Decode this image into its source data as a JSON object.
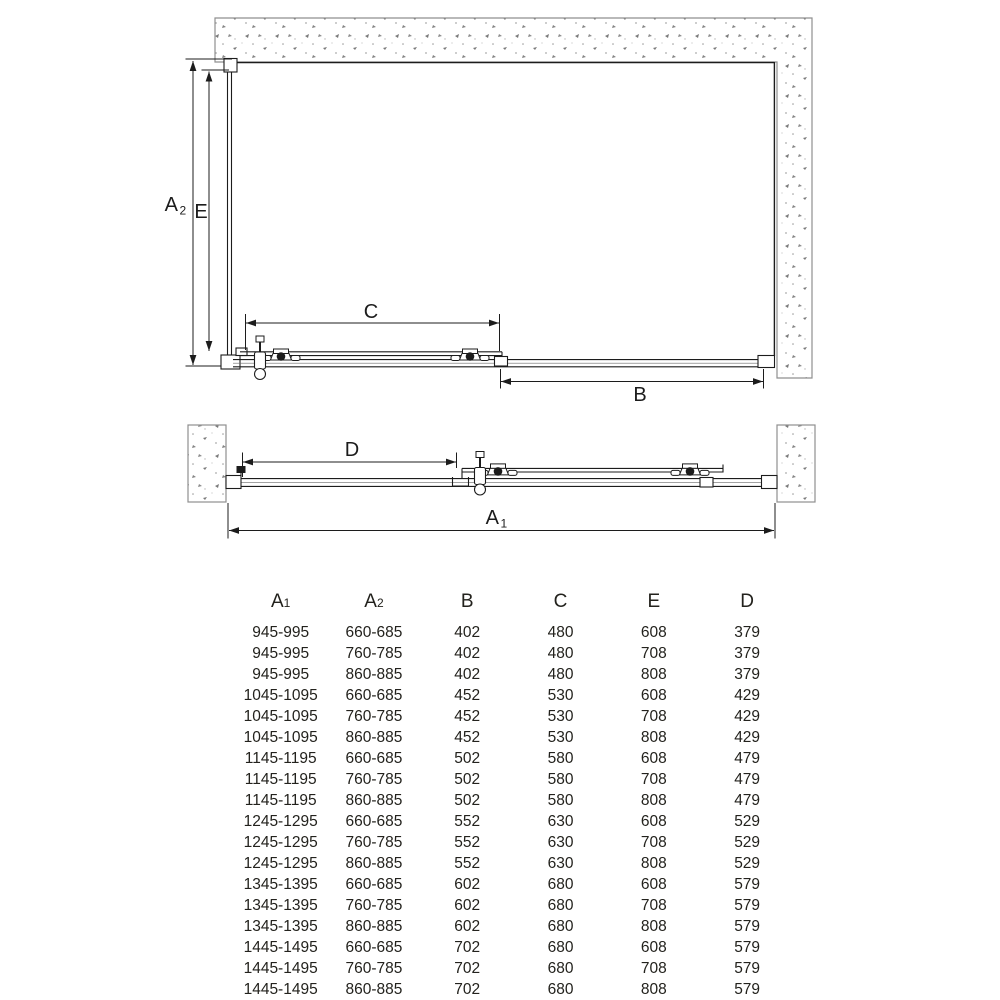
{
  "diagram": {
    "colors": {
      "line": "#1c1c1c",
      "wall_outline": "#8f8f8f",
      "background": "#ffffff"
    },
    "plan_view": {
      "dim_a2_base": "A",
      "dim_a2_sub": "2",
      "dim_e": "E",
      "dim_c": "C",
      "dim_b": "B"
    },
    "profile_view": {
      "dim_d": "D",
      "dim_a1_base": "A",
      "dim_a1_sub": "1"
    }
  },
  "table": {
    "headers": [
      {
        "base": "A",
        "sub": "1"
      },
      {
        "base": "A",
        "sub": "2"
      },
      {
        "base": "B",
        "sub": ""
      },
      {
        "base": "C",
        "sub": ""
      },
      {
        "base": "E",
        "sub": ""
      },
      {
        "base": "D",
        "sub": ""
      }
    ],
    "rows": [
      [
        "945-995",
        "660-685",
        "402",
        "480",
        "608",
        "379"
      ],
      [
        "945-995",
        "760-785",
        "402",
        "480",
        "708",
        "379"
      ],
      [
        "945-995",
        "860-885",
        "402",
        "480",
        "808",
        "379"
      ],
      [
        "1045-1095",
        "660-685",
        "452",
        "530",
        "608",
        "429"
      ],
      [
        "1045-1095",
        "760-785",
        "452",
        "530",
        "708",
        "429"
      ],
      [
        "1045-1095",
        "860-885",
        "452",
        "530",
        "808",
        "429"
      ],
      [
        "1145-1195",
        "660-685",
        "502",
        "580",
        "608",
        "479"
      ],
      [
        "1145-1195",
        "760-785",
        "502",
        "580",
        "708",
        "479"
      ],
      [
        "1145-1195",
        "860-885",
        "502",
        "580",
        "808",
        "479"
      ],
      [
        "1245-1295",
        "660-685",
        "552",
        "630",
        "608",
        "529"
      ],
      [
        "1245-1295",
        "760-785",
        "552",
        "630",
        "708",
        "529"
      ],
      [
        "1245-1295",
        "860-885",
        "552",
        "630",
        "808",
        "529"
      ],
      [
        "1345-1395",
        "660-685",
        "602",
        "680",
        "608",
        "579"
      ],
      [
        "1345-1395",
        "760-785",
        "602",
        "680",
        "708",
        "579"
      ],
      [
        "1345-1395",
        "860-885",
        "602",
        "680",
        "808",
        "579"
      ],
      [
        "1445-1495",
        "660-685",
        "702",
        "680",
        "608",
        "579"
      ],
      [
        "1445-1495",
        "760-785",
        "702",
        "680",
        "708",
        "579"
      ],
      [
        "1445-1495",
        "860-885",
        "702",
        "680",
        "808",
        "579"
      ]
    ]
  }
}
